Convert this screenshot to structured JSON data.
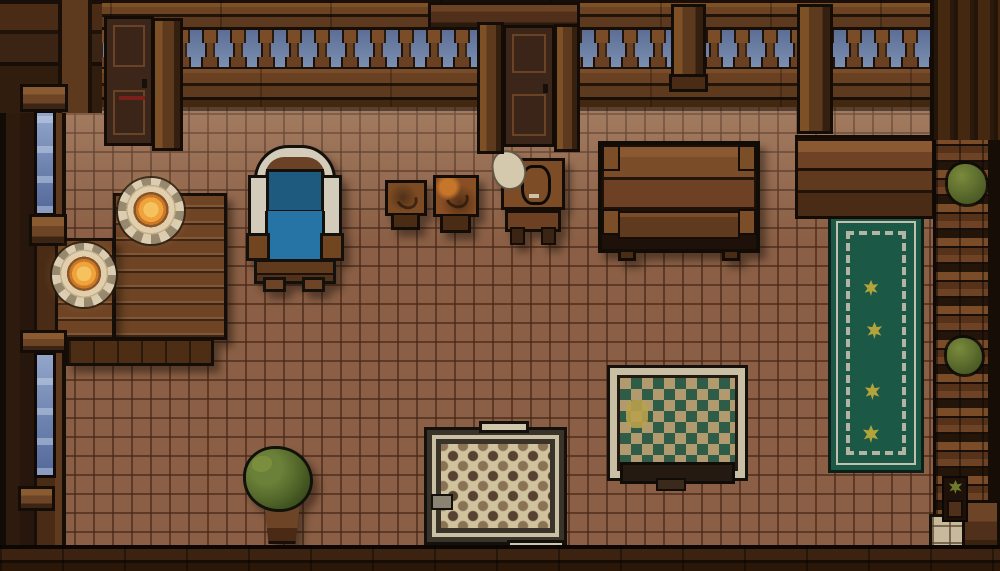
{
  "scene": {
    "kind": "pixel-art top-down room (tavern interior)",
    "width": 1000,
    "height": 571,
    "palette": {
      "sky": "#7b8fb3",
      "sky_dark": "#5c6e93",
      "floor_tile": "#8a5f45",
      "floor_grout": "#6f4832",
      "window_blue": "#6d83af",
      "window_blue_light": "#93a6c9",
      "table_wood": "#6e4425",
      "chair_blue": "#2673a6",
      "chair_blue_dark": "#1d5a7d",
      "chair_frame": "#d3ccba",
      "plate_white": "#ded7c3",
      "flame_orange": "#eda23c",
      "flame_bright": "#f7cf6e",
      "rug_green": "#1c5846",
      "rug_white": "#c4bfae",
      "flower_yellow": "#b3a33c",
      "rug_tan": "#b29a6f",
      "rug_diamond": "#2e5c46",
      "rug_cream": "#cfc29d",
      "bush_light": "#7a8a3c",
      "bush_green": "#55652a",
      "bush_dark": "#394c1c"
    },
    "objects": [
      {
        "name": "tile-floor",
        "x": 36,
        "y": 100,
        "w": 964,
        "h": 452
      },
      {
        "name": "runner-rug",
        "x": 828,
        "y": 213,
        "w": 96,
        "h": 260
      },
      {
        "name": "rug-flower-1",
        "x": 863,
        "y": 280,
        "w": 16,
        "h": 16
      },
      {
        "name": "rug-flower-2",
        "x": 866,
        "y": 322,
        "w": 17,
        "h": 17
      },
      {
        "name": "rug-flower-3",
        "x": 864,
        "y": 383,
        "w": 17,
        "h": 17
      },
      {
        "name": "rug-flower-4",
        "x": 862,
        "y": 425,
        "w": 18,
        "h": 18
      },
      {
        "name": "diamond-rug",
        "x": 607,
        "y": 365,
        "w": 141,
        "h": 116
      },
      {
        "name": "checker-rug",
        "x": 424,
        "y": 427,
        "w": 143,
        "h": 118
      },
      {
        "name": "top-wall",
        "x": 0,
        "y": 0,
        "w": 1000,
        "h": 107
      },
      {
        "name": "corner-top-left",
        "x": 0,
        "y": 0,
        "w": 102,
        "h": 113
      },
      {
        "name": "corner-top-right",
        "x": 930,
        "y": 0,
        "w": 70,
        "h": 140
      },
      {
        "name": "center-door-header",
        "x": 428,
        "y": 2,
        "w": 152,
        "h": 28
      },
      {
        "name": "post-left-door",
        "x": 152,
        "y": 18,
        "w": 31,
        "h": 133
      },
      {
        "name": "post-center-left",
        "x": 477,
        "y": 22,
        "w": 27,
        "h": 132
      },
      {
        "name": "post-center-right",
        "x": 554,
        "y": 24,
        "w": 26,
        "h": 128
      },
      {
        "name": "post-mid-right",
        "x": 671,
        "y": 4,
        "w": 35,
        "h": 80
      },
      {
        "name": "post-far-right",
        "x": 797,
        "y": 4,
        "w": 36,
        "h": 130
      },
      {
        "name": "door-left",
        "x": 104,
        "y": 16,
        "w": 50,
        "h": 130
      },
      {
        "name": "door-center",
        "x": 503,
        "y": 25,
        "w": 52,
        "h": 122
      },
      {
        "name": "left-wall",
        "x": 0,
        "y": 0,
        "w": 66,
        "h": 571
      },
      {
        "name": "window-upper",
        "x": 34,
        "y": 110,
        "w": 22,
        "h": 106
      },
      {
        "name": "window-lower",
        "x": 34,
        "y": 352,
        "w": 22,
        "h": 126
      },
      {
        "name": "ledge-top-left",
        "x": 20,
        "y": 84,
        "w": 48,
        "h": 28
      },
      {
        "name": "sill-window-upper",
        "x": 29,
        "y": 214,
        "w": 38,
        "h": 32
      },
      {
        "name": "header-window-lower",
        "x": 20,
        "y": 330,
        "w": 47,
        "h": 23
      },
      {
        "name": "sill-window-lower",
        "x": 18,
        "y": 486,
        "w": 37,
        "h": 25
      },
      {
        "name": "right-counter",
        "x": 795,
        "y": 135,
        "w": 140,
        "h": 84
      },
      {
        "name": "right-shelves",
        "x": 933,
        "y": 100,
        "w": 67,
        "h": 470
      },
      {
        "name": "shelf-bush-upper",
        "x": 948,
        "y": 164,
        "w": 38,
        "h": 40
      },
      {
        "name": "shelf-bush-lower",
        "x": 947,
        "y": 338,
        "w": 35,
        "h": 36
      },
      {
        "name": "small-plant-bottom-right",
        "x": 942,
        "y": 476,
        "w": 26,
        "h": 46
      },
      {
        "name": "light-tiles-bottom-right",
        "x": 929,
        "y": 514,
        "w": 36,
        "h": 50
      },
      {
        "name": "corner-box-bottom-right",
        "x": 962,
        "y": 500,
        "w": 38,
        "h": 68
      },
      {
        "name": "bottom-wall",
        "x": 0,
        "y": 545,
        "w": 1000,
        "h": 26
      },
      {
        "name": "dining-table-right",
        "x": 113,
        "y": 193,
        "w": 114,
        "h": 147
      },
      {
        "name": "dining-table-left",
        "x": 55,
        "y": 238,
        "w": 60,
        "h": 102
      },
      {
        "name": "dining-bench",
        "x": 66,
        "y": 338,
        "w": 148,
        "h": 28
      },
      {
        "name": "candle-plate-top",
        "x": 118,
        "y": 178,
        "w": 66,
        "h": 66
      },
      {
        "name": "candle-plate-left",
        "x": 52,
        "y": 243,
        "w": 64,
        "h": 64
      },
      {
        "name": "armchair",
        "x": 248,
        "y": 145,
        "w": 94,
        "h": 147
      },
      {
        "name": "stool-small-left",
        "x": 385,
        "y": 180,
        "w": 42,
        "h": 50
      },
      {
        "name": "stool-small-right",
        "x": 433,
        "y": 175,
        "w": 46,
        "h": 58
      },
      {
        "name": "nightstand",
        "x": 501,
        "y": 158,
        "w": 64,
        "h": 90
      },
      {
        "name": "bench-table",
        "x": 598,
        "y": 141,
        "w": 162,
        "h": 112
      },
      {
        "name": "potted-plant",
        "x": 246,
        "y": 449,
        "w": 72,
        "h": 99
      },
      {
        "name": "vignette",
        "x": 0,
        "y": 0,
        "w": 1000,
        "h": 571
      }
    ]
  }
}
